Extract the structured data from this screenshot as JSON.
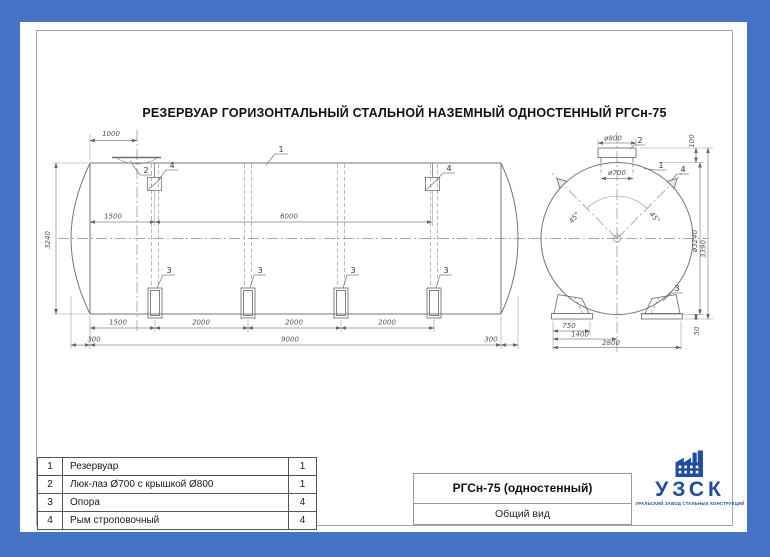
{
  "colors": {
    "border_blue": "#4573c5",
    "logo_blue": "#1d4ea3",
    "line_gray": "#777777"
  },
  "title": "РЕЗЕРВУАР ГОРИЗОНТАЛЬНЫЙ СТАЛЬНОЙ НАЗЕМНЫЙ ОДНОСТЕННЫЙ РГСн-75",
  "callouts": {
    "tank": "1",
    "manhole": "2",
    "support": "3",
    "lug": "4"
  },
  "side_view": {
    "dims": {
      "d1000": "1000",
      "d1500_top": "1500",
      "d6000": "6000",
      "d3240": "3240",
      "d1500": "1500",
      "d2000": "2000",
      "d300": "300",
      "d9000": "9000"
    }
  },
  "end_view": {
    "dims": {
      "d800": "ø800",
      "d700": "ø700",
      "d100": "100",
      "d3240": "ø3240",
      "d3390": "3390",
      "d50": "50",
      "d750": "750",
      "d1400": "1400",
      "d2800": "2800",
      "d45": "45°"
    }
  },
  "parts_table": {
    "rows": [
      {
        "num": "1",
        "name": "Резервуар",
        "qty": "1"
      },
      {
        "num": "2",
        "name": "Люк-лаз Ø700 с крышкой Ø800",
        "qty": "1"
      },
      {
        "num": "3",
        "name": "Опора",
        "qty": "4"
      },
      {
        "num": "4",
        "name": "Рым строповочный",
        "qty": "4"
      }
    ]
  },
  "title_block": {
    "model": "РГСн-75 (одностенный)",
    "view_name": "Общий вид"
  },
  "logo": {
    "abbr": "УЗСК",
    "tagline": "УРАЛЬСКИЙ ЗАВОД СТАЛЬНЫХ КОНСТРУКЦИЙ"
  }
}
